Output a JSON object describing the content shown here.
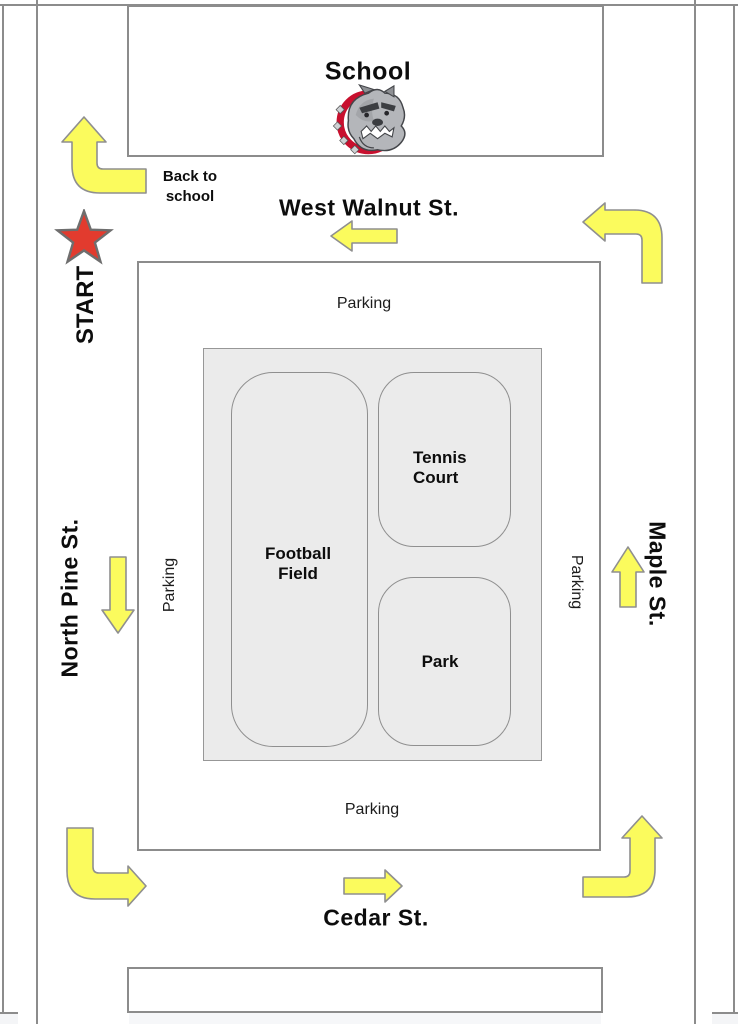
{
  "school": {
    "label": "School"
  },
  "route": {
    "start_label": "START",
    "back_to_school": {
      "line1": "Back to",
      "line2": "school"
    },
    "arrows": [
      {
        "id": "back-to-school-turn-arrow",
        "type": "turn",
        "direction": "left-then-up"
      },
      {
        "id": "west-walnut-arrow",
        "type": "straight",
        "direction": "left"
      },
      {
        "id": "top-right-turn-arrow",
        "type": "turn",
        "direction": "up-then-left"
      },
      {
        "id": "north-pine-arrow",
        "type": "straight",
        "direction": "down"
      },
      {
        "id": "maple-arrow",
        "type": "straight",
        "direction": "up"
      },
      {
        "id": "bottom-left-turn-arrow",
        "type": "turn",
        "direction": "down-then-right"
      },
      {
        "id": "cedar-arrow",
        "type": "straight",
        "direction": "right"
      },
      {
        "id": "bottom-right-turn-arrow",
        "type": "turn",
        "direction": "right-then-up"
      }
    ]
  },
  "streets": {
    "top": "West Walnut St.",
    "left": "North Pine St.",
    "right": "Maple St.",
    "bottom": "Cedar St."
  },
  "campus": {
    "parking_top": "Parking",
    "parking_bottom": "Parking",
    "parking_left": "Parking",
    "parking_right": "Parking",
    "football": {
      "line1": "Football",
      "line2": "Field"
    },
    "tennis": {
      "line1": "Tennis",
      "line2": "Court"
    },
    "park": "Park"
  },
  "icons": {
    "mascot": "bulldog-logo",
    "start_marker": "red-star"
  },
  "colors": {
    "arrow_yellow": "#FBFB5D",
    "star_red": "#E23B2E",
    "line_gray": "#8C8C8C",
    "block_fill": "#EBEBEB",
    "collar_red": "#C8102E"
  }
}
